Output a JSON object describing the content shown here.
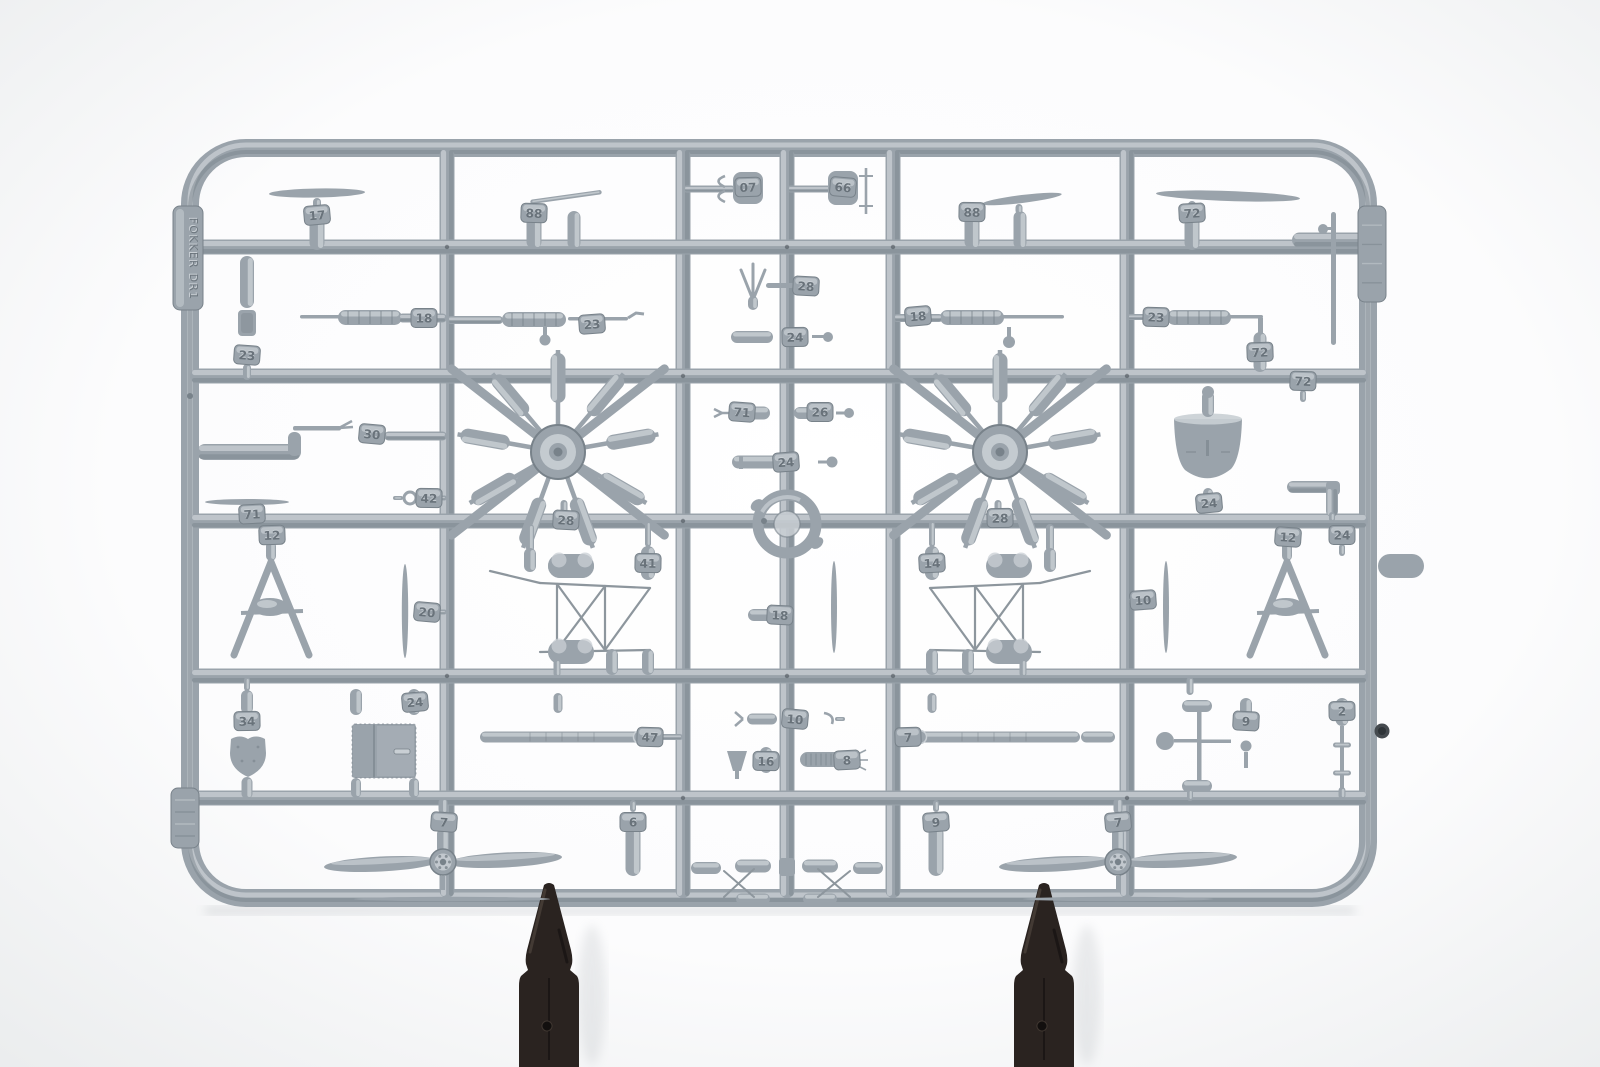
{
  "scene": {
    "subject": "Photograph of a light-gray injection-molded plastic model-kit sprue (Fokker Dr.I triplane parts: two rotary engines, two propellers, machine guns, struts, cowling) on a white background, held upright by two dark plastic clips at the bottom",
    "background_color": "#f1f2f3",
    "plastic_base_color": "#9aa3ab",
    "plastic_highlight_color": "#c9cfd4",
    "plastic_shadow_color": "#78828a",
    "wire_color": "#8d969d",
    "clip_color": "#2a2320",
    "clip_highlight_color": "#5d5148",
    "tag_text_color": "#626c74"
  },
  "embossed": {
    "left_tag_text": "FOKKER DR1",
    "part_numbers": [
      "17",
      "88",
      "07",
      "66",
      "88",
      "72",
      "23",
      "18",
      "23",
      "28",
      "24",
      "18",
      "23",
      "72",
      "30",
      "42",
      "71",
      "71",
      "26",
      "24",
      "28",
      "28",
      "24",
      "72",
      "12",
      "20",
      "41",
      "14",
      "12",
      "24",
      "10",
      "18",
      "34",
      "24",
      "47",
      "7",
      "10",
      "16",
      "8",
      "7",
      "6",
      "9",
      "9",
      "2",
      "7"
    ]
  }
}
